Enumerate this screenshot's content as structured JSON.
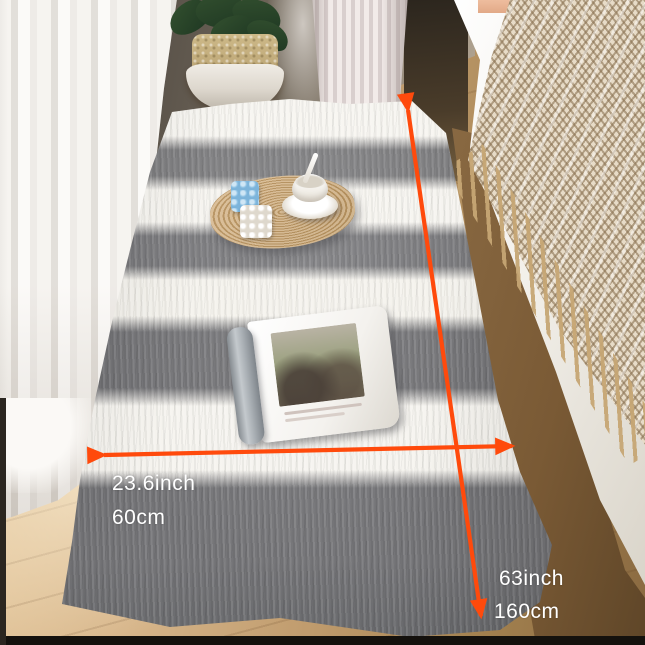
{
  "annotations": {
    "arrow_color": "#ff4a0c",
    "width_label": {
      "inch": "23.6inch",
      "cm": "60cm"
    },
    "length_label": {
      "inch": "63inch",
      "cm": "160cm"
    }
  },
  "icons": {
    "width_arrow": "double-headed-horizontal-arrow",
    "length_arrow": "double-headed-vertical-arrow"
  },
  "palette": {
    "rug_white": "#f6f4ef",
    "rug_gray": "#77777a",
    "floor_wood": "#c9a87e",
    "throw_beige": "#e7dbc7",
    "curtain_white": "#f3f0eb"
  }
}
